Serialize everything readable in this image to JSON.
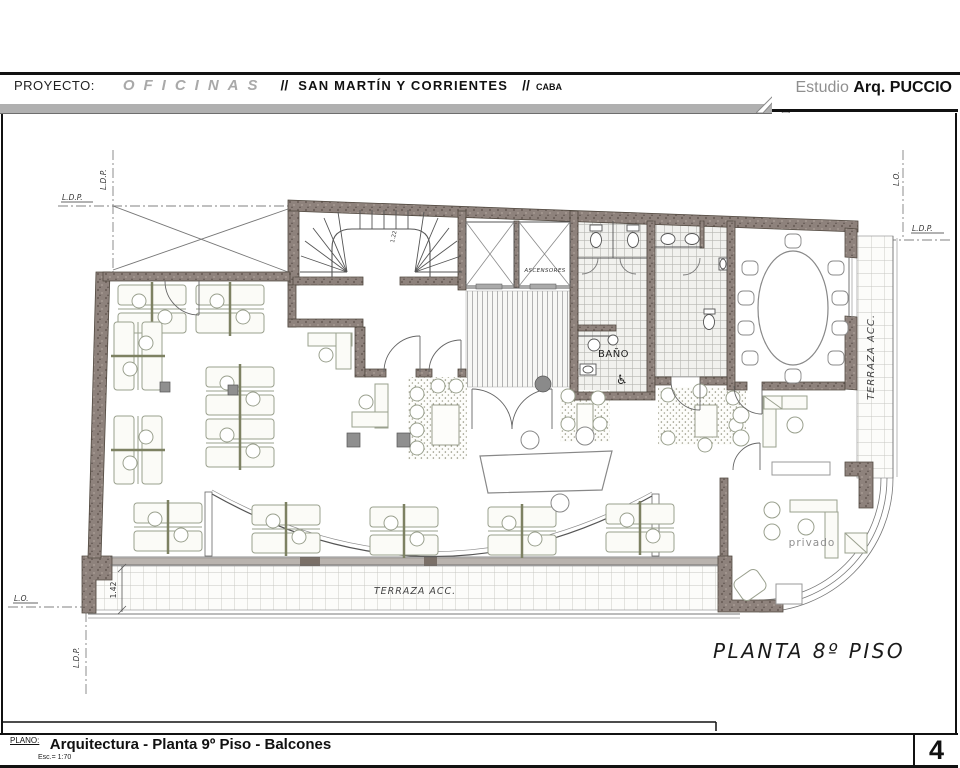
{
  "header": {
    "proyecto_label": "PROYECTO:",
    "project_type": "OFICINAS",
    "sep1": "//",
    "location": "SAN MARTÍN Y CORRIENTES",
    "sep2": "//",
    "city": "CABA",
    "studio_prefix": "Estudio",
    "studio_name": "Arq. PUCCIO"
  },
  "plan": {
    "caption": "PLANTA 8º PISO",
    "labels": {
      "ascensores": "ASCENSORES",
      "bano": "BAÑO",
      "wheelchair": "♿",
      "terraza": "TERRAZA ACC.",
      "privado": "privado"
    },
    "refs": {
      "ldp": "L.D.P.",
      "lo": "L.O."
    },
    "dims": {
      "terrace": "1.42",
      "stair": "1.22"
    }
  },
  "title_block": {
    "plano_label": "PLANO:",
    "title": "Arquitectura - Planta 9º Piso - Balcones",
    "scale": "Esc.= 1:70",
    "sheet_number": "4"
  },
  "colors": {
    "wall": "#8e827c",
    "wall_dark": "#6c605a",
    "line": "#4a4542",
    "tile": "#c3c3c0",
    "furniture": "#9aa08e",
    "header_bar": "#b0b0b0"
  }
}
